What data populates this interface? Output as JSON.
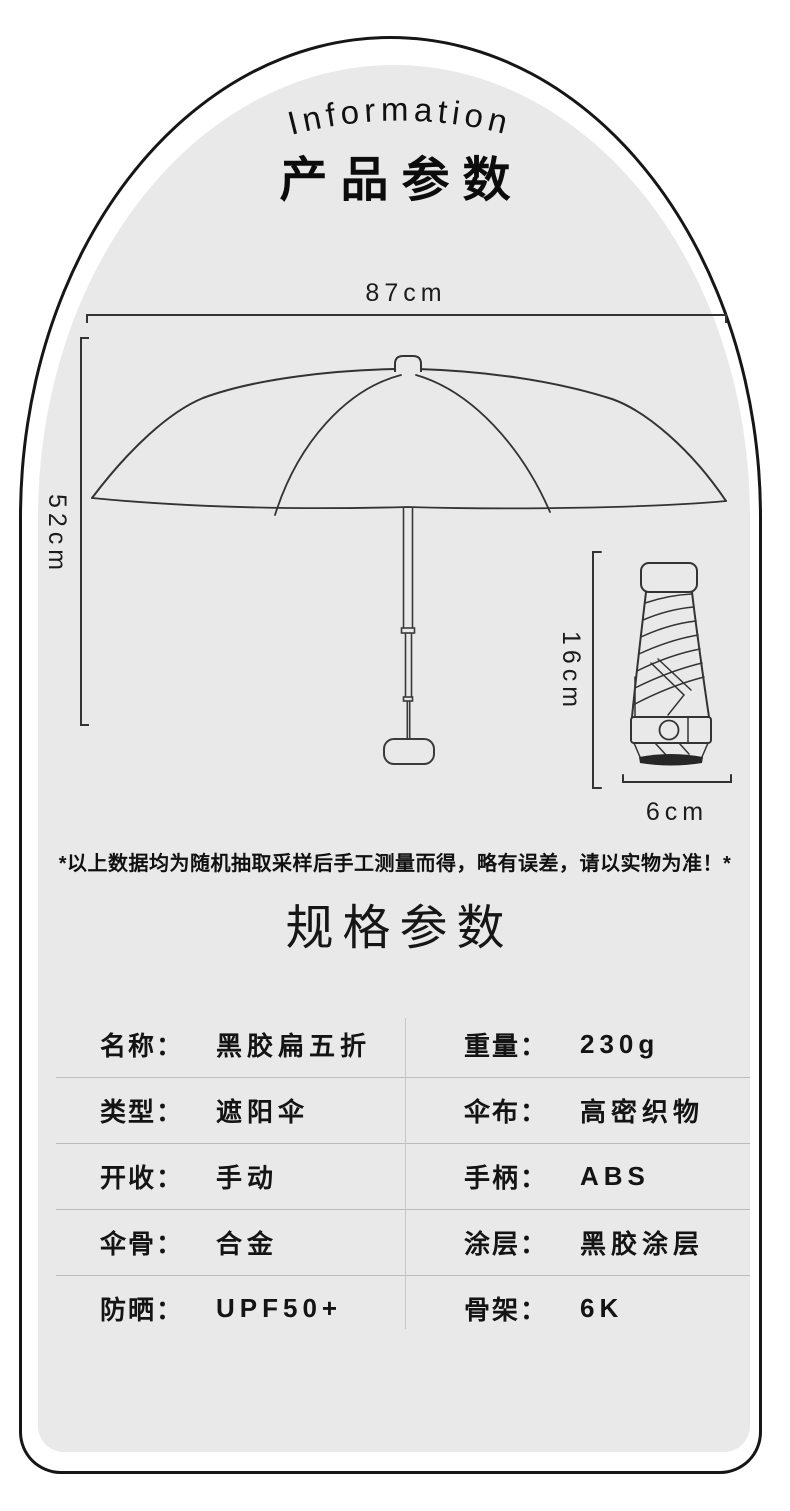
{
  "colors": {
    "panel_bg": "#e9e9e9",
    "card_outline": "#161616",
    "line_art": "#333333",
    "table_divider": "#bcbcbc",
    "text": "#141414"
  },
  "header": {
    "arc_title": "Information",
    "title": "产品参数"
  },
  "diagram": {
    "open_umbrella": {
      "width_label": "87cm",
      "height_label": "52cm"
    },
    "folded_umbrella": {
      "height_label": "16cm",
      "width_label": "6cm"
    },
    "note": "*以上数据均为随机抽取采样后手工测量而得，略有误差，请以实物为准！*"
  },
  "specs": {
    "title": "规格参数",
    "rows": [
      {
        "left": {
          "label": "名称：",
          "value": "黑胶扁五折"
        },
        "right": {
          "label": "重量：",
          "value": "230g"
        }
      },
      {
        "left": {
          "label": "类型：",
          "value": "遮阳伞"
        },
        "right": {
          "label": "伞布：",
          "value": "高密织物"
        }
      },
      {
        "left": {
          "label": "开收：",
          "value": "手动"
        },
        "right": {
          "label": "手柄：",
          "value": "ABS"
        }
      },
      {
        "left": {
          "label": "伞骨：",
          "value": "合金"
        },
        "right": {
          "label": "涂层：",
          "value": "黑胶涂层"
        }
      },
      {
        "left": {
          "label": "防晒：",
          "value": "UPF50+"
        },
        "right": {
          "label": "骨架：",
          "value": "6K"
        }
      }
    ]
  }
}
